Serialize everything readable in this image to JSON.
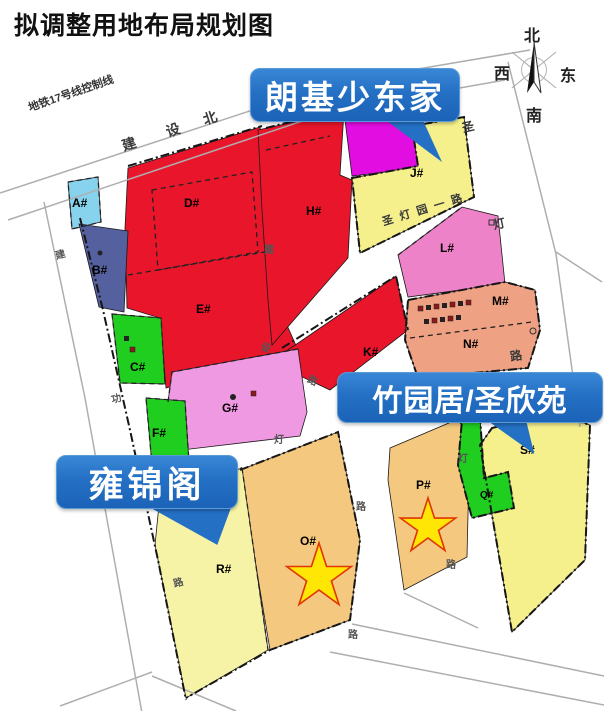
{
  "title": "拟调整用地布局规划图",
  "compass": {
    "north": "北",
    "south": "南",
    "west": "西",
    "east": "东"
  },
  "callouts": {
    "langji": "朗基少东家",
    "zhuyuan": "竹园居/圣欣苑",
    "yongjin": "雍锦阁"
  },
  "roads": {
    "metro_line": "地铁17号线控制线",
    "top": [
      "建",
      "设",
      "北"
    ],
    "left": [
      "建",
      "功",
      "路"
    ],
    "center": [
      "建",
      "设",
      "路"
    ],
    "shengdengyuan": "圣灯园一路",
    "shengdeng": [
      "圣",
      "灯",
      "路"
    ],
    "op_road": [
      "灯",
      "路"
    ],
    "pq_road": [
      "灯",
      "路"
    ],
    "o_south": "路"
  },
  "parcels": {
    "a": {
      "label": "A#"
    },
    "b": {
      "label": "B#"
    },
    "c": {
      "label": "C#"
    },
    "d": {
      "label": "D#"
    },
    "e": {
      "label": "E#"
    },
    "f": {
      "label": "F#"
    },
    "g": {
      "label": "G#"
    },
    "h": {
      "label": "H#"
    },
    "j": {
      "label": "J#"
    },
    "k": {
      "label": "K#"
    },
    "l": {
      "label": "L#"
    },
    "m": {
      "label": "M#"
    },
    "n": {
      "label": "N#"
    },
    "o": {
      "label": "O#"
    },
    "p": {
      "label": "P#"
    },
    "q": {
      "label": "Q#"
    },
    "r": {
      "label": "R#"
    },
    "s": {
      "label": "S#"
    }
  },
  "markers": {
    "stars_on": [
      "O#",
      "P#"
    ]
  },
  "colors": {
    "red": "#e8152b",
    "pink_g": "#ef99e2",
    "pink_l": "#ee82c8",
    "salmon": "#efa183",
    "yellow": "#f5f08c",
    "yellow_light": "#f7f3a6",
    "tan": "#f4c87e",
    "green": "#1fce1f",
    "cyan": "#87d3ee",
    "slate": "#55619e",
    "magenta": "#e10de1",
    "callout_blue": "#2470c4",
    "star_fill": "#ffe605",
    "star_stroke": "#e03505",
    "road_gray": "#aeaeae",
    "boundary_black": "#151515"
  }
}
